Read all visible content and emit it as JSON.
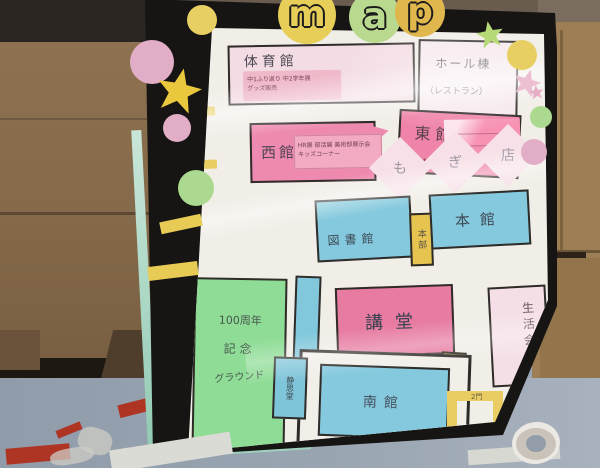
{
  "title_letters": {
    "m": "m",
    "a": "a",
    "p": "p"
  },
  "map_labels": {
    "gym": "体育館",
    "gym_note1": "中1ふり返り 中2学年展",
    "gym_note2": "グッズ販売",
    "hall": "ホール棟",
    "hall_sub": "（レストラン）",
    "east": "東館",
    "east_sub": "高校棟",
    "west": "西館",
    "west_note1": "HR展 部活展 美術部展示会",
    "west_note2": "キッズコーナー",
    "mogi1": "も",
    "mogi2": "ぎ",
    "mogi3": "店",
    "library": "図書館",
    "hq": "本部",
    "main_building": "本館",
    "ground1": "100周年",
    "ground2": "記念",
    "ground3": "グラウンド",
    "auditorium": "講堂",
    "reception": "受付",
    "seikatsu": "生活会館",
    "south": "南館",
    "seishido": "静思堂",
    "gate_left": "正門",
    "gate_bottom": "2門"
  },
  "colors": {
    "pink_dark": "#ee8ab0",
    "pink_light": "#f3dce3",
    "note_pink": "#f3abc3",
    "blue": "#84c9dd",
    "green": "#8edc95",
    "yellow": "#e7c44f",
    "board_black": "#171513",
    "board_edge_teal": "#9fd3be",
    "poster_white": "#f1ede7",
    "floor_grey": "#98a4b2",
    "cardboard_brown": "#8d7150",
    "tape_red": "#ae3424"
  }
}
